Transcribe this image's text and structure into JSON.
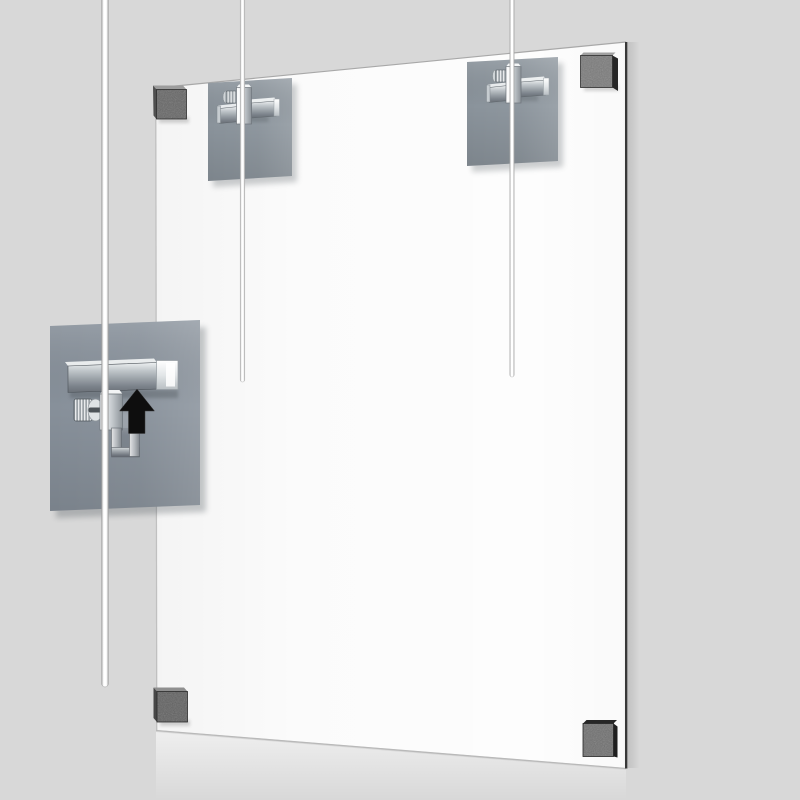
{
  "scene": {
    "width": 800,
    "height": 800,
    "subject": "cable-suspended-panel-hanging-system-illustration"
  },
  "colors": {
    "background": "#d8d8d8",
    "panel_face": "#fdfdfd",
    "panel_edge_dark": "#3a3a3a",
    "panel_edge_light": "#c2c2c2",
    "mounting_plate": "#8a939b",
    "detail_plate": "#87909a",
    "chrome_light": "#f2f4f5",
    "chrome_mid": "#b9bfc4",
    "chrome_dark": "#6e757b",
    "cable_white": "#ffffff",
    "cable_edge": "#a8a8a8",
    "arrow_black": "#0e0e0e",
    "corner_pads": {
      "top_left": "#656565",
      "top_right": "#7a7a7a",
      "bottom_left": "#606060",
      "bottom_right": "#6f6f6f"
    }
  },
  "parts": {
    "panel": "suspended-acrylic-panel",
    "cables": [
      "left-hanging-cable",
      "center-hanging-cable",
      "right-hanging-cable"
    ],
    "grippers": [
      "detail-cable-gripper",
      "top-center-cable-gripper",
      "top-right-cable-gripper"
    ],
    "corner_pads": [
      "top-left",
      "top-right",
      "bottom-left",
      "bottom-right"
    ],
    "annotation": "up-arrow"
  }
}
